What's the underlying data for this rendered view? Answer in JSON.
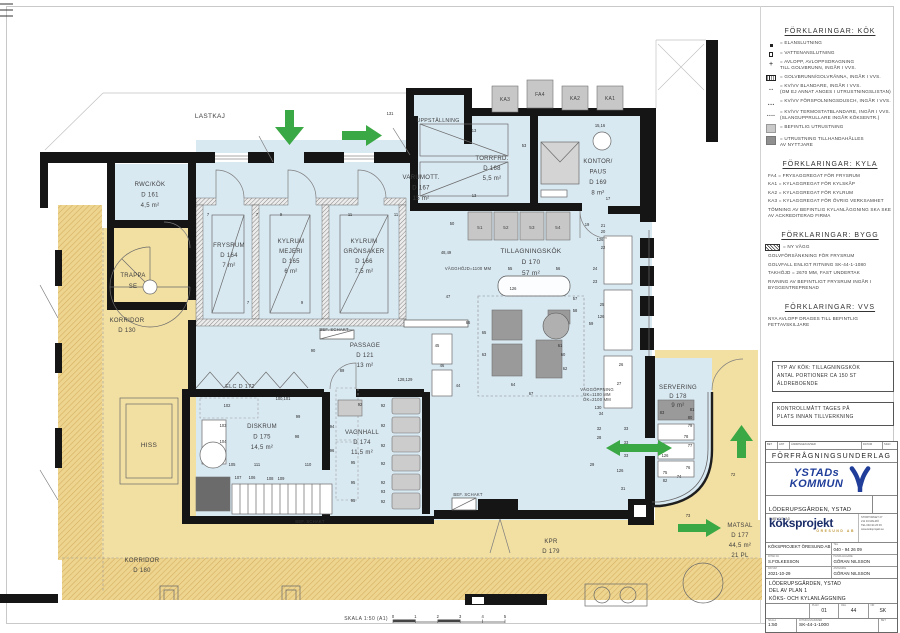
{
  "sheet": {
    "scale_label": "SKALA  1:50 (A1)",
    "scale_ticks": [
      "0",
      "1",
      "2",
      "3",
      "4",
      "5"
    ]
  },
  "plan": {
    "colors": {
      "room_fill": "#d9e9f2",
      "corridor_fill": "#f2dfa2",
      "wall": "#151515",
      "arrow_green": "#3aa844",
      "equipment_light": "#c7c7c7",
      "equipment_dark": "#9a9a9a"
    },
    "room_labels": [
      {
        "n": "label-lastkaj",
        "x": 210,
        "y": 118,
        "s": 6.5,
        "lines": [
          "LASTKAJ"
        ]
      },
      {
        "n": "label-uppstallning",
        "x": 438,
        "y": 122,
        "s": 5.2,
        "lines": [
          "UPPSTÄLLNING"
        ]
      },
      {
        "n": "label-rwc-kok",
        "x": 150,
        "y": 186,
        "lh": 10.5,
        "lines": [
          "RWC/KÖK",
          "D 161",
          "4,5 m²"
        ]
      },
      {
        "n": "label-frysrum",
        "x": 229,
        "y": 247,
        "lh": 10,
        "lines": [
          "FRYSRUM",
          "D 164",
          "7 m²"
        ]
      },
      {
        "n": "label-kylrum-mejeri",
        "x": 291,
        "y": 243,
        "lh": 10,
        "lines": [
          "KYLRUM",
          "MEJERI",
          "D 165",
          "6 m²"
        ]
      },
      {
        "n": "label-kylrum-gronsaker",
        "x": 364,
        "y": 243,
        "lh": 10,
        "lines": [
          "KYLRUM",
          "GRÖNSAKER",
          "D 166",
          "7,5 m²"
        ]
      },
      {
        "n": "label-varumott",
        "x": 421,
        "y": 179,
        "lh": 10.5,
        "lines": [
          "VARUMOTT.",
          "D 167",
          "15 m²"
        ]
      },
      {
        "n": "label-torrfrd",
        "x": 492,
        "y": 160,
        "lh": 10,
        "lines": [
          "TORRFRD.",
          "D 168",
          "5,5 m²"
        ]
      },
      {
        "n": "label-kontor-paus",
        "x": 598,
        "y": 163,
        "lh": 10.5,
        "lines": [
          "KONTOR/",
          "PAUS",
          "D 169",
          "8 m²"
        ]
      },
      {
        "n": "label-tillagningskok",
        "x": 531,
        "y": 253,
        "s": 6.5,
        "lh": 11,
        "lines": [
          "TILLAGNINGSKÖK",
          "D 170",
          "57 m²"
        ]
      },
      {
        "n": "label-passage",
        "x": 365,
        "y": 347,
        "lh": 10,
        "lines": [
          "PASSAGE",
          "D 121",
          "13 m²"
        ]
      },
      {
        "n": "label-elc",
        "x": 240,
        "y": 388,
        "s": 5.5,
        "lines": [
          "ELC  D 172"
        ]
      },
      {
        "n": "label-diskrum",
        "x": 262,
        "y": 428,
        "lh": 10.5,
        "lines": [
          "DISKRUM",
          "D 175",
          "14,5 m²"
        ]
      },
      {
        "n": "label-vagnhall",
        "x": 362,
        "y": 434,
        "lh": 10,
        "lines": [
          "VAGNHALL",
          "D 174",
          "11,5 m²"
        ]
      },
      {
        "n": "label-servering",
        "x": 678,
        "y": 389,
        "lh": 9,
        "lines": [
          "SERVERING",
          "D 178",
          "9 m²"
        ]
      },
      {
        "n": "label-matsal",
        "x": 740,
        "y": 527,
        "lh": 10,
        "lines": [
          "MATSAL",
          "D 177",
          "44,5 m²",
          "21 PL"
        ]
      },
      {
        "n": "label-kpr",
        "x": 551,
        "y": 543,
        "lh": 10,
        "lines": [
          "KPR",
          "D 179"
        ]
      },
      {
        "n": "label-korridor-130",
        "x": 127,
        "y": 322,
        "lh": 10,
        "lines": [
          "KORRIDOR",
          "D 130"
        ]
      },
      {
        "n": "label-trappa",
        "x": 133,
        "y": 277,
        "lh": 11,
        "lines": [
          "TRAPPA",
          "SE"
        ]
      },
      {
        "n": "label-hiss",
        "x": 149,
        "y": 447,
        "s": 6.5,
        "lines": [
          "HISS"
        ]
      },
      {
        "n": "label-korridor-180",
        "x": 142,
        "y": 562,
        "lh": 10,
        "lines": [
          "KORRIDOR",
          "D 180"
        ]
      },
      {
        "n": "label-ka3",
        "x": 505,
        "y": 101,
        "s": 5,
        "lines": [
          "KA3"
        ]
      },
      {
        "n": "label-fa4",
        "x": 540,
        "y": 96,
        "s": 5,
        "lines": [
          "FA4"
        ]
      },
      {
        "n": "label-ka2",
        "x": 575,
        "y": 100,
        "s": 5,
        "lines": [
          "KA2"
        ]
      },
      {
        "n": "label-ka1",
        "x": 610,
        "y": 100,
        "s": 5,
        "lines": [
          "KA1"
        ]
      },
      {
        "n": "label-eq-51",
        "x": 480,
        "y": 229,
        "s": 4.5,
        "lines": [
          "51"
        ]
      },
      {
        "n": "label-eq-52",
        "x": 506,
        "y": 229,
        "s": 4.5,
        "lines": [
          "52"
        ]
      },
      {
        "n": "label-eq-53",
        "x": 532,
        "y": 229,
        "s": 4.5,
        "lines": [
          "53"
        ]
      },
      {
        "n": "label-eq-54",
        "x": 558,
        "y": 229,
        "s": 4.5,
        "lines": [
          "54"
        ]
      }
    ],
    "annotations": [
      {
        "n": "note-wall-height",
        "x": 468,
        "y": 270,
        "lines": [
          "VÄGGHÖJD=1100 MM"
        ]
      },
      {
        "n": "note-wall-opening",
        "x": 597,
        "y": 391,
        "lh": 5,
        "lines": [
          "VÄGGÖPPNING",
          "UK=1100 MM",
          "ÖK=2100 MM"
        ]
      },
      {
        "n": "note-bef-schakt-1",
        "x": 334,
        "y": 331,
        "lines": [
          "BEF. SCHAKT"
        ]
      },
      {
        "n": "note-bef-schakt-2",
        "x": 310,
        "y": 523,
        "lines": [
          "BEF. SCHAKT"
        ]
      },
      {
        "n": "note-bef-schakt-3",
        "x": 468,
        "y": 496,
        "lines": [
          "BEF. SCHAKT"
        ]
      }
    ],
    "tags": [
      [
        390,
        115,
        "131"
      ],
      [
        474,
        132,
        "13"
      ],
      [
        474,
        197,
        "13"
      ],
      [
        524,
        147,
        "53"
      ],
      [
        600,
        127,
        "15,16"
      ],
      [
        608,
        200,
        "17"
      ],
      [
        587,
        226,
        "19"
      ],
      [
        603,
        227,
        "21"
      ],
      [
        208,
        216,
        "7"
      ],
      [
        257,
        216,
        "7"
      ],
      [
        281,
        216,
        "9"
      ],
      [
        350,
        216,
        "11"
      ],
      [
        396,
        216,
        "11"
      ],
      [
        248,
        304,
        "7"
      ],
      [
        302,
        304,
        "9"
      ],
      [
        452,
        225,
        "50"
      ],
      [
        448,
        298,
        "47"
      ],
      [
        446,
        254,
        "48,49"
      ],
      [
        510,
        270,
        "55"
      ],
      [
        558,
        270,
        "56"
      ],
      [
        513,
        290,
        "126"
      ],
      [
        575,
        300,
        "57"
      ],
      [
        575,
        312,
        "58"
      ],
      [
        591,
        325,
        "59"
      ],
      [
        560,
        347,
        "61"
      ],
      [
        563,
        356,
        "60"
      ],
      [
        565,
        370,
        "62"
      ],
      [
        484,
        356,
        "63"
      ],
      [
        513,
        386,
        "64"
      ],
      [
        484,
        334,
        "65"
      ],
      [
        468,
        324,
        "66"
      ],
      [
        531,
        395,
        "67"
      ],
      [
        458,
        387,
        "44"
      ],
      [
        437,
        347,
        "45"
      ],
      [
        442,
        367,
        "46"
      ],
      [
        603,
        233,
        "20"
      ],
      [
        600,
        241,
        "126"
      ],
      [
        603,
        249,
        "22"
      ],
      [
        595,
        270,
        "24"
      ],
      [
        595,
        283,
        "23"
      ],
      [
        602,
        306,
        "25"
      ],
      [
        601,
        318,
        "126"
      ],
      [
        621,
        366,
        "26"
      ],
      [
        619,
        385,
        "27"
      ],
      [
        662,
        414,
        "83"
      ],
      [
        692,
        411,
        "81"
      ],
      [
        690,
        419,
        "80"
      ],
      [
        690,
        427,
        "79"
      ],
      [
        686,
        438,
        "78"
      ],
      [
        690,
        447,
        "77"
      ],
      [
        688,
        469,
        "76"
      ],
      [
        733,
        476,
        "72"
      ],
      [
        688,
        517,
        "73"
      ],
      [
        665,
        474,
        "75"
      ],
      [
        679,
        478,
        "74"
      ],
      [
        665,
        482,
        "82"
      ],
      [
        665,
        457,
        "126"
      ],
      [
        620,
        472,
        "126"
      ],
      [
        626,
        430,
        "33"
      ],
      [
        626,
        444,
        "33"
      ],
      [
        626,
        457,
        "33"
      ],
      [
        599,
        430,
        "32"
      ],
      [
        599,
        439,
        "28"
      ],
      [
        601,
        415,
        "34"
      ],
      [
        598,
        409,
        "130"
      ],
      [
        623,
        490,
        "31"
      ],
      [
        592,
        466,
        "29"
      ],
      [
        313,
        352,
        "90"
      ],
      [
        342,
        372,
        "89"
      ],
      [
        283,
        400,
        "100,101"
      ],
      [
        227,
        407,
        "102"
      ],
      [
        223,
        427,
        "103"
      ],
      [
        223,
        443,
        "104"
      ],
      [
        232,
        466,
        "105"
      ],
      [
        257,
        466,
        "111"
      ],
      [
        238,
        479,
        "107"
      ],
      [
        252,
        479,
        "106"
      ],
      [
        270,
        480,
        "108"
      ],
      [
        281,
        480,
        "109"
      ],
      [
        308,
        466,
        "110"
      ],
      [
        298,
        418,
        "99"
      ],
      [
        297,
        438,
        "98"
      ],
      [
        332,
        428,
        "94"
      ],
      [
        332,
        452,
        "96"
      ],
      [
        353,
        464,
        "95"
      ],
      [
        353,
        484,
        "95"
      ],
      [
        353,
        502,
        "95"
      ],
      [
        360,
        406,
        "92"
      ],
      [
        383,
        407,
        "92"
      ],
      [
        383,
        427,
        "92"
      ],
      [
        383,
        447,
        "92"
      ],
      [
        383,
        465,
        "92"
      ],
      [
        383,
        484,
        "92"
      ],
      [
        383,
        493,
        "93"
      ],
      [
        383,
        503,
        "92"
      ],
      [
        405,
        381,
        "128,129"
      ]
    ]
  },
  "legend_kok": {
    "title": "FÖRKLARINGAR: KÖK",
    "items": [
      {
        "glyph": "square-filled",
        "t1": "= ELANSLUTNING"
      },
      {
        "glyph": "square-open",
        "t1": "= VATTENANSLUTNING"
      },
      {
        "glyph": "plus",
        "t1": "= AVLOPP, AVLOPPSDRAGNING",
        "t2": "TILL GOLVBRUNN, INGÅR I VVS."
      },
      {
        "glyph": "floor-drain",
        "t1": "= GOLVBRUNN/GOLVRÄNNA, INGÅR I VVS."
      },
      {
        "glyph": "dots-2",
        "t1": "= KV/VV BLANDARE, INGÅR I VVS.",
        "t2": "(OM EJ ANNAT ANGES I UTRUSTNINGSLISTAN)"
      },
      {
        "glyph": "dots-3",
        "t1": "= KV/VV FÖRSPOLNINGSDUSCH, INGÅR I VVS."
      },
      {
        "glyph": "dots-4",
        "t1": "= KV/VV TERMOSTATBLANDARE, INGÅR I VVS.",
        "t2": "(SLANGUPPRULLARE INGÅR KÖKSENTR.)"
      },
      {
        "glyph": "swatch-light",
        "t1": "= BEFINTLIG UTRUSTNING"
      },
      {
        "glyph": "swatch-dark",
        "t1": "= UTRUSTNING TILLHANDAHÅLLES",
        "t2": "AV NYTTJARE"
      }
    ]
  },
  "legend_kyla": {
    "title": "FÖRKLARINGAR: KYLA",
    "items": [
      {
        "t1": "FA4 = FRYSAGGREGAT FÖR FRYSRUM"
      },
      {
        "t1": "KA1 = KYLAGGREGAT FÖR KYLSKÅP"
      },
      {
        "t1": "KA2 = KYLAGGREGAT FÖR KYLRUM"
      },
      {
        "t1": "KA3 = KYLAGGREGAT FÖR ÖVRIG VERKSAMHET"
      },
      {
        "t1": "TÖMNING AV BEFINTLIG KYLANLÄGGNING SKA SKE",
        "t2": "AV ACKREDITERAD FIRMA"
      }
    ]
  },
  "legend_bygg": {
    "title": "FÖRKLARINGAR: BYGG",
    "items": [
      {
        "glyph": "hatch",
        "t1": "= NY VÄGG"
      },
      {
        "t1": "GOLVFÖRSÄNKNING FÖR FRYSRUM"
      },
      {
        "t1": "GOLVFALL ENLIGT RITNING SK-44-1-1080"
      },
      {
        "t1": "TAKHÖJD = 2670 MM, FAST UNDERTAK"
      },
      {
        "t1": "RIVNING AV BEFINTLIGT FRYSRUM INGÅR I",
        "t2": "BYGGENTREPRENAD"
      }
    ]
  },
  "legend_vvs": {
    "title": "FÖRKLARINGAR: VVS",
    "items": [
      {
        "t1": "NYA AVLOPP DRAGES TILL BEFINTLIG",
        "t2": "FETTAVSKILJARE"
      }
    ]
  },
  "note_typ": {
    "line1": "TYP AV KÖK: TILLAGNINGSKÖK",
    "line2": "ANTAL PORTIONER CA 150 ST",
    "line3": "ÄLDREBOENDE"
  },
  "note_kontroll": {
    "line1": "KONTROLLMÅTT TAGES PÅ",
    "line2": "PLATS INNAN TILLVERKNING"
  },
  "titleblock": {
    "revision_headers": [
      "BET",
      "ANT",
      "ÄNDRINGEN AVSER",
      "DATUM",
      "SIGN"
    ],
    "status": "FÖRFRÅGNINGSUNDERLAG",
    "client_logo": {
      "line1": "YSTADs",
      "line2": "KOMMUN"
    },
    "project": "LÖDERUPSGÅRDEN, YSTAD",
    "project_sub": "OMBYGGNAD",
    "consult_logo": {
      "name": "köksprojekt",
      "sub": "ÖRESUND AB",
      "address": [
        "STORTORGET 27",
        "211 34 MALMÖ",
        "TEL 040-94 26 09",
        "www.koksprojekt.se"
      ]
    },
    "fields": [
      {
        "label": "",
        "value": "KÖKSPROJEKT ÖRESUND AB"
      },
      {
        "label": "TEL",
        "value": "040 - 94 26 09"
      },
      {
        "label": "RITAD AV",
        "value": "S.FOLKESSON"
      },
      {
        "label": "HANDLÄGGARE",
        "value": "GÖRAN NILSSON"
      },
      {
        "label": "DATUM",
        "value": "2021-10-29"
      },
      {
        "label": "ANSVARIG",
        "value": "GÖRAN NILSSON"
      }
    ],
    "object_line1": "LÖDERUPSGÅRDEN, YSTAD",
    "object_line2": "DEL AV PLAN 1",
    "object_line3": "KÖKS- OCH KYLANLÄGGNING",
    "meta": {
      "plan_label": "PLAN",
      "plan": "01",
      "del_label": "DEL",
      "del": "44",
      "nr_label": "NR",
      "nr": "SK"
    },
    "scale_label": "SKALA",
    "scale": "1:50",
    "drawing_no_label": "RITNINGSNUMMER",
    "drawing_no": "SK-44-1-1000",
    "bet_label": "BET"
  }
}
